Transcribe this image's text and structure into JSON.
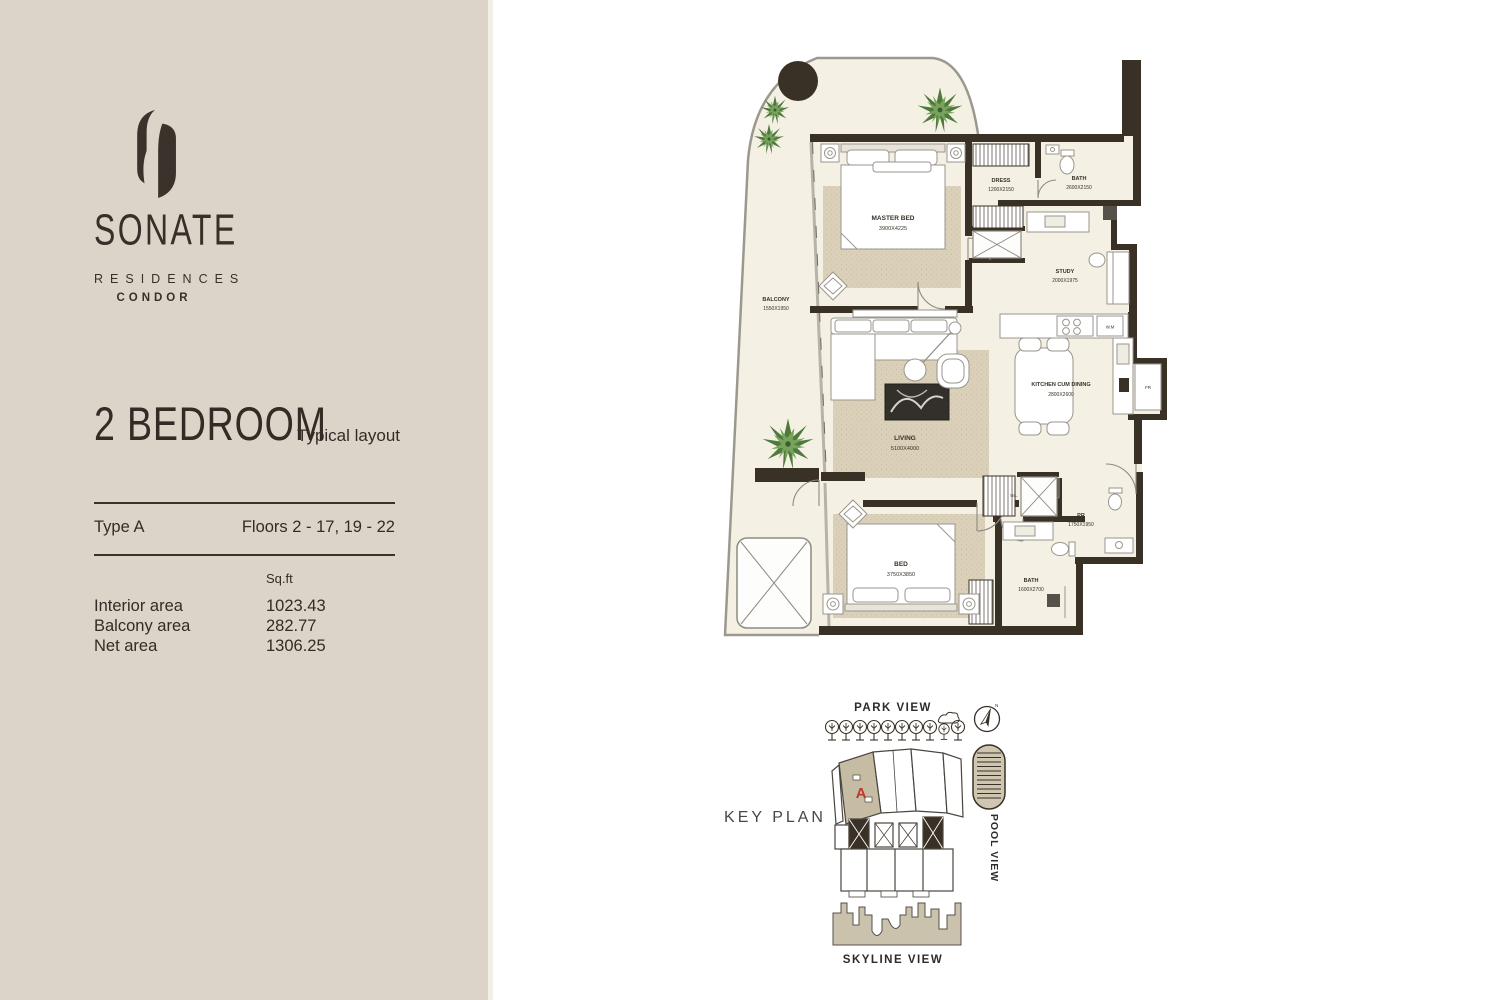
{
  "brand": {
    "name": "SONATE",
    "division": "RESIDENCES",
    "collection": "CONDOR"
  },
  "plan_info": {
    "title": "2 BEDROOM",
    "subtitle": "Typical layout",
    "type": "Type A",
    "floors": "Floors 2 - 17, 19 - 22",
    "unit_header": "Sq.ft",
    "rows": [
      {
        "label": "Interior area",
        "value": "1023.43"
      },
      {
        "label": "Balcony area",
        "value": "282.77"
      },
      {
        "label": "Net area",
        "value": "1306.25"
      }
    ]
  },
  "floorplan": {
    "master_bed": {
      "name": "MASTER BED",
      "dims": "3900X4225"
    },
    "dress": {
      "name": "DRESS",
      "dims": "1200X2150"
    },
    "bath1": {
      "name": "BATH",
      "dims": "2600X2150"
    },
    "study": {
      "name": "STUDY",
      "dims": "2000X1975"
    },
    "kitchen": {
      "name": "KITCHEN CUM DINING",
      "dims": "2800X2600"
    },
    "living": {
      "name": "LIVING",
      "dims": "5100X4000"
    },
    "balcony": {
      "name": "BALCONY",
      "dims": "1550X1950"
    },
    "bed2": {
      "name": "BED",
      "dims": "3750X3850"
    },
    "bath2": {
      "name": "BATH",
      "dims": "1600X2700"
    },
    "pr": {
      "name": "PR",
      "dims": "1750X1950"
    },
    "wm": "W.M",
    "fr": "FR",
    "tel": "TEL."
  },
  "keyplan": {
    "label": "KEY PLAN",
    "park_view": "PARK VIEW",
    "pool_view": "POOL VIEW",
    "skyline_view": "SKYLINE VIEW",
    "unit_marker": "A",
    "compass_north": "N"
  },
  "colors": {
    "sidebar_bg": "#dcd4c8",
    "wall": "#3a3126",
    "floor": "#f4f0e3",
    "carpet": "#d9cfb8",
    "accent_red": "#bf382c"
  }
}
